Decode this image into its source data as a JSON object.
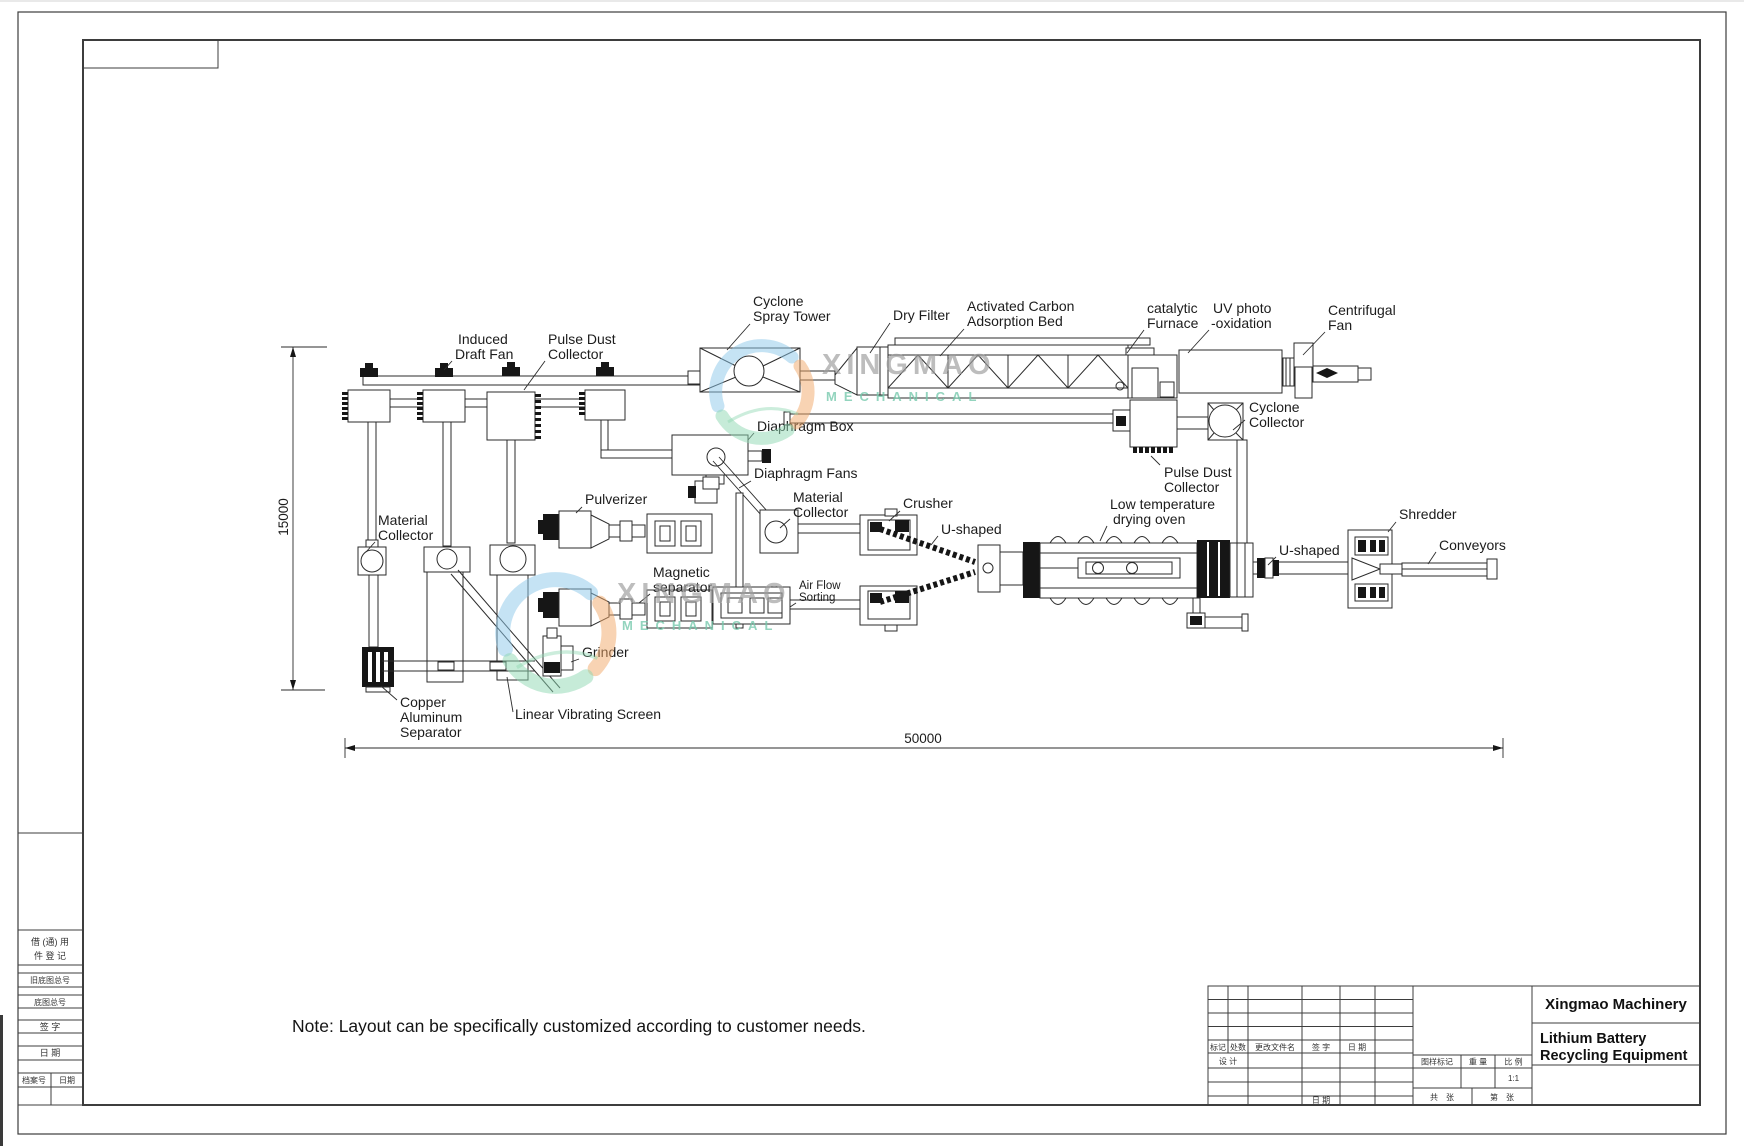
{
  "watermark": {
    "brand": "XINGMAO",
    "sub": "MECHANICAL"
  },
  "colors": {
    "swoosh_blue": "#8BC7E9",
    "swoosh_orange": "#F2A768",
    "swoosh_green": "#8ED8B2",
    "brand_text": "#9E9E9E",
    "sub_text": "#76C9AC",
    "line": "#2b2b2b"
  },
  "labels": {
    "cyclone_spray_tower": [
      "Cyclone",
      "Spray Tower"
    ],
    "dry_filter": [
      "Dry Filter"
    ],
    "activated_carbon_bed": [
      "Activated Carbon",
      "Adsorption Bed"
    ],
    "catalytic_furnace": [
      "catalytic",
      "Furnace"
    ],
    "uv_photo_oxidation": [
      "UV photo",
      "-oxidation"
    ],
    "centrifugal_fan": [
      "Centrifugal",
      "Fan"
    ],
    "induced_draft_fan": [
      "Induced",
      "Draft Fan"
    ],
    "pulse_dust_collector_top": [
      "Pulse Dust",
      "Collector"
    ],
    "diaphragm_box": [
      "Diaphragm Box"
    ],
    "diaphragm_fans": [
      "Diaphragm Fans"
    ],
    "material_collector_mid": [
      "Material",
      "Collector"
    ],
    "pulverizer": [
      "Pulverizer"
    ],
    "magnetic_separator": [
      "Magnetic",
      "separator"
    ],
    "air_flow_sorting": [
      "Air Flow",
      "Sorting"
    ],
    "crusher": [
      "Crusher"
    ],
    "u_shaped_1": [
      "U-shaped"
    ],
    "low_temperature_drying_oven": [
      "Low temperature",
      "drying oven"
    ],
    "cyclone_collector": [
      "Cyclone",
      "Collector"
    ],
    "pulse_dust_collector_2": [
      "Pulse Dust",
      "Collector"
    ],
    "shredder": [
      "Shredder"
    ],
    "u_shaped_2": [
      "U-shaped"
    ],
    "conveyors": [
      "Conveyors"
    ],
    "material_collector_left": [
      "Material",
      "Collector"
    ],
    "copper_aluminum_separator": [
      "Copper",
      "Aluminum",
      "Separator"
    ],
    "linear_vibrating_screen": [
      "Linear Vibrating Screen"
    ],
    "grinder": [
      "Grinder"
    ]
  },
  "dimensions": {
    "vertical": "15000",
    "horizontal": "50000"
  },
  "note": "Note: Layout can be specifically customized according to customer needs.",
  "title_block": {
    "company": "Xingmao Machinery",
    "product": [
      "Lithium Battery",
      "Recycling Equipment"
    ],
    "rev_headers": [
      "标记",
      "处数",
      "更改文件名",
      "签 字",
      "日 期"
    ],
    "design_label": "设 计",
    "date_label": "日 期",
    "mark_header": "图样标记",
    "weight_header": "重 量",
    "scale_header": "比 例",
    "scale_value": "1:1",
    "sheets_total": "共　张",
    "sheet_no": "第　张"
  },
  "margin_column": {
    "reg_line1": "借 (通) 用",
    "reg_line2": "件 登 记",
    "old_base_no": "旧底图总号",
    "base_no": "底图总号",
    "sign": "签 字",
    "date": "日 期",
    "file_no": "档案号",
    "file_date": "日期"
  }
}
